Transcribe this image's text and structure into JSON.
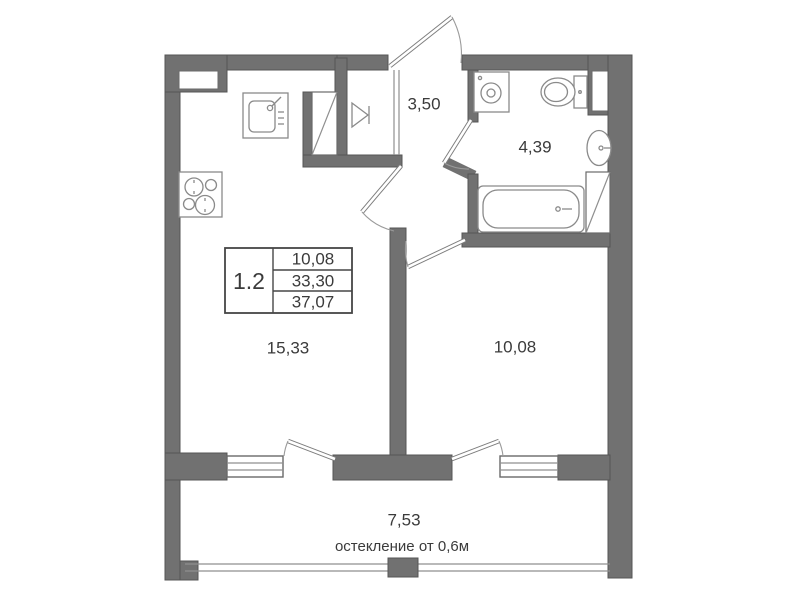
{
  "plan": {
    "type": "apartment-floor-plan",
    "unit": {
      "number": "1.2",
      "table": [
        "10,08",
        "33,30",
        "37,07"
      ]
    },
    "rooms": {
      "hallway": {
        "area": "3,50"
      },
      "bathroom": {
        "area": "4,39"
      },
      "bedroom": {
        "area": "10,08"
      },
      "living_kitchen": {
        "area": "15,33"
      },
      "balcony": {
        "area": "7,53",
        "note": "остекление от 0,6м"
      }
    },
    "fixtures": [
      "kitchen-sink",
      "stove",
      "wardrobe",
      "kitchen-vent-shaft",
      "washing-machine",
      "toilet",
      "washbasin",
      "bathtub",
      "bathroom-vent-shaft"
    ],
    "colors": {
      "wall": "#717171",
      "line": "#8a8a8a",
      "text": "#3b3b3b",
      "background": "#ffffff"
    }
  }
}
